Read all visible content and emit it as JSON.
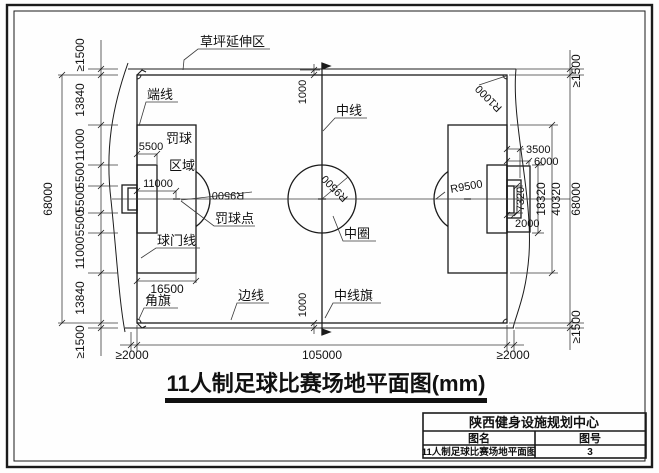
{
  "drawing": {
    "title": "11人制足球比赛场地平面图(mm)",
    "labels": {
      "grass_zone": "草坪延伸区",
      "end_line": "端线",
      "center_line": "中线",
      "penalty_word": "罚球",
      "area_word": "区域",
      "penalty_spot": "罚球点",
      "goal_line": "球门线",
      "corner_flag": "角旗",
      "side_line": "边线",
      "center_circle": "中圈",
      "center_line_flag": "中线旗"
    },
    "dims": {
      "left_chain": [
        "≥1500",
        "13840",
        "11000",
        "5500",
        "5500",
        "5500",
        "11000",
        "13840",
        "≥1500"
      ],
      "right_chain": [
        "≥1500",
        "68000",
        "≥1500"
      ],
      "bottom_chain": [
        "≥2000",
        "105000",
        "≥2000"
      ],
      "field_width": "68000",
      "goal_area_depth": "5500",
      "penalty_mark_dist": "11000",
      "penalty_area_depth": "16500",
      "goal_width": "7320",
      "goal_area_width": "18320",
      "penalty_area_width": "40320",
      "behind_goal_a": "3500",
      "behind_goal_b": "6000",
      "goal_depth": "2000",
      "flag_offset": "1000",
      "circle_radius": "R9500",
      "corner_radius": "R1000"
    }
  },
  "title_block": {
    "company": "陕西健身设施规划中心",
    "name_label": "图名",
    "number_label": "图号",
    "drawing_name": "11人制足球比赛场地平面图",
    "drawing_number": "3"
  }
}
